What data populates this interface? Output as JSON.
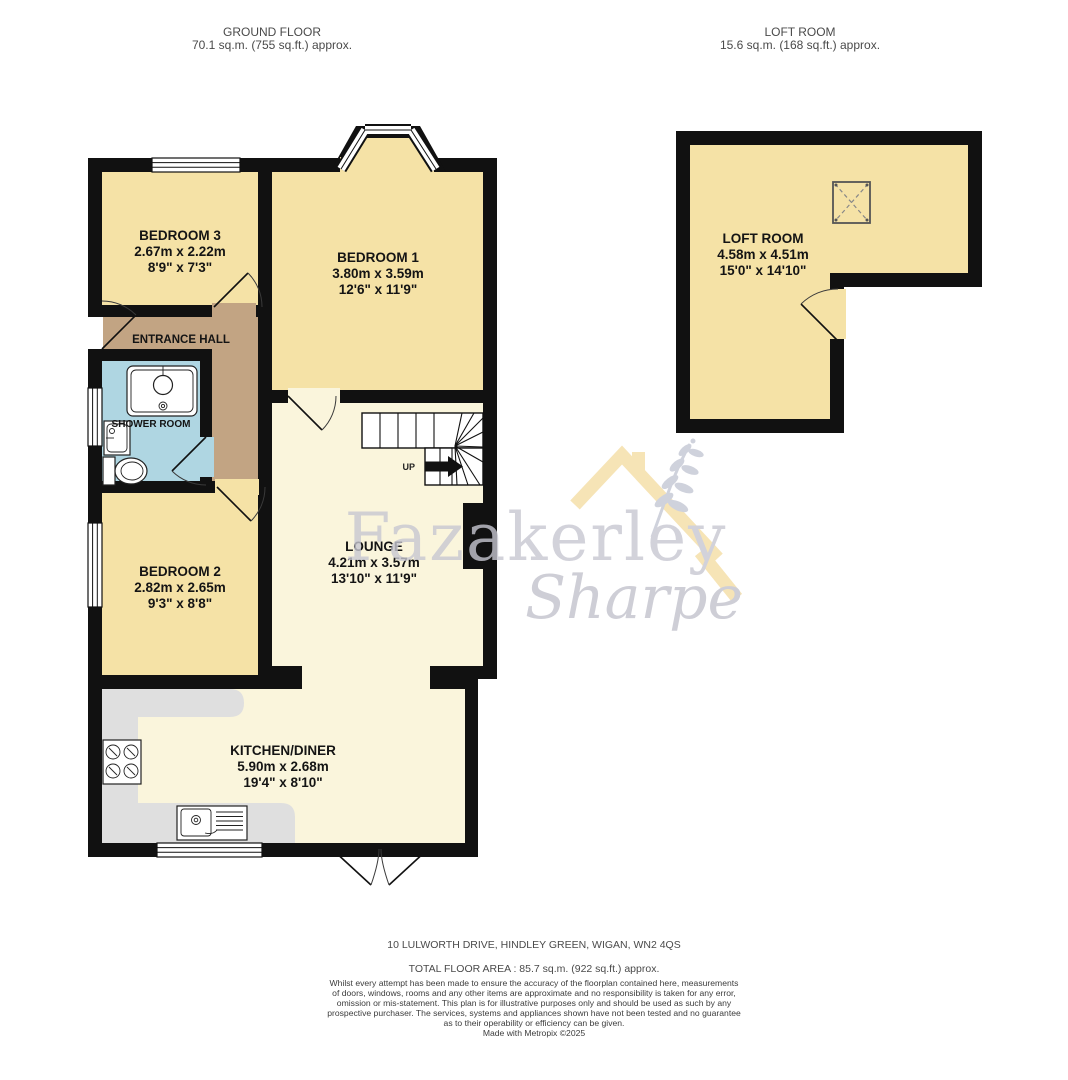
{
  "headers": {
    "ground_floor": {
      "title": "GROUND FLOOR",
      "area": "70.1 sq.m. (755 sq.ft.) approx."
    },
    "loft": {
      "title": "LOFT ROOM",
      "area": "15.6 sq.m. (168 sq.ft.) approx."
    }
  },
  "rooms": {
    "bedroom3": {
      "name": "BEDROOM 3",
      "metric": "2.67m x 2.22m",
      "imperial": "8'9\" x 7'3\""
    },
    "bedroom1": {
      "name": "BEDROOM 1",
      "metric": "3.80m x 3.59m",
      "imperial": "12'6\" x 11'9\""
    },
    "entrance_hall": {
      "name": "ENTRANCE HALL"
    },
    "shower_room": {
      "name": "SHOWER ROOM"
    },
    "bedroom2": {
      "name": "BEDROOM 2",
      "metric": "2.82m x 2.65m",
      "imperial": "9'3\" x 8'8\""
    },
    "lounge": {
      "name": "LOUNGE",
      "metric": "4.21m x 3.57m",
      "imperial": "13'10\" x 11'9\""
    },
    "kitchen_diner": {
      "name": "KITCHEN/DINER",
      "metric": "5.90m x 2.68m",
      "imperial": "19'4\" x 8'10\""
    },
    "loft_room": {
      "name": "LOFT ROOM",
      "metric": "4.58m x 4.51m",
      "imperial": "15'0\" x 14'10\""
    }
  },
  "stairs": {
    "label": "UP"
  },
  "watermark": {
    "line1": "Fazakerley",
    "line2": "Sharpe"
  },
  "footer": {
    "address": "10 LULWORTH DRIVE, HINDLEY GREEN, WIGAN, WN2 4QS",
    "total_area": "TOTAL FLOOR AREA : 85.7 sq.m. (922 sq.ft.) approx.",
    "disclaimer": [
      "Whilst every attempt has been made to ensure the accuracy of the floorplan contained here, measurements",
      "of doors, windows, rooms and any other items are approximate and no responsibility is taken for any error,",
      "omission or mis-statement. This plan is for illustrative purposes only and should be used as such by any",
      "prospective purchaser. The services, systems and appliances shown have not been tested and no guarantee",
      "as to their operability or efficiency can be given.",
      "Made with Metropix ©2025"
    ]
  },
  "colors": {
    "room_yellow": "#F5E2A6",
    "room_cream": "#FAF5DC",
    "hall_tan": "#C2A483",
    "shower_blue": "#AFD6E2",
    "counter_grey": "#DFDFDF",
    "wall_black": "#111111",
    "watermark_grey": "#C7C7D1",
    "watermark_roof_yellow": "#F3D795"
  }
}
